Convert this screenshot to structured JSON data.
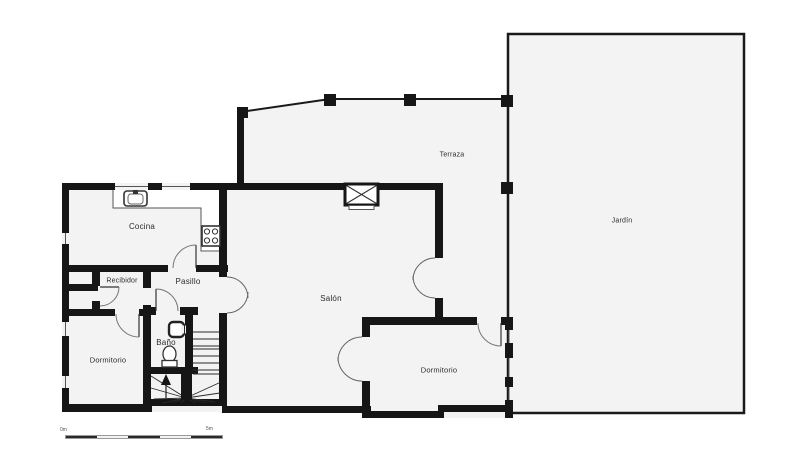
{
  "plan": {
    "type": "floor-plan",
    "rooms": {
      "cocina": {
        "label": "Cocina"
      },
      "recibidor": {
        "label": "Recibidor"
      },
      "pasillo": {
        "label": "Pasillo"
      },
      "bano": {
        "label": "Baño"
      },
      "dormitorio_izq": {
        "label": "Dormitorio"
      },
      "salon": {
        "label": "Salón"
      },
      "terraza": {
        "label": "Terraza"
      },
      "jardin": {
        "label": "Jardín"
      },
      "dormitorio_der": {
        "label": "Dormitorio"
      }
    },
    "scale_bar": {
      "start_label": "0m",
      "end_label": "5m",
      "segments": 5
    },
    "icons": [
      "sink-icon",
      "stove-icon",
      "toilet-icon",
      "washbasin-icon",
      "fireplace-icon",
      "stairs-icon",
      "door-arc-icon",
      "double-door-icon",
      "pillar-icon",
      "window-icon"
    ],
    "colors": {
      "wall": "#161616",
      "floor": "#f3f3f3",
      "background": "#ffffff",
      "thin_line": "#555555",
      "text": "#2b2b2b"
    }
  }
}
